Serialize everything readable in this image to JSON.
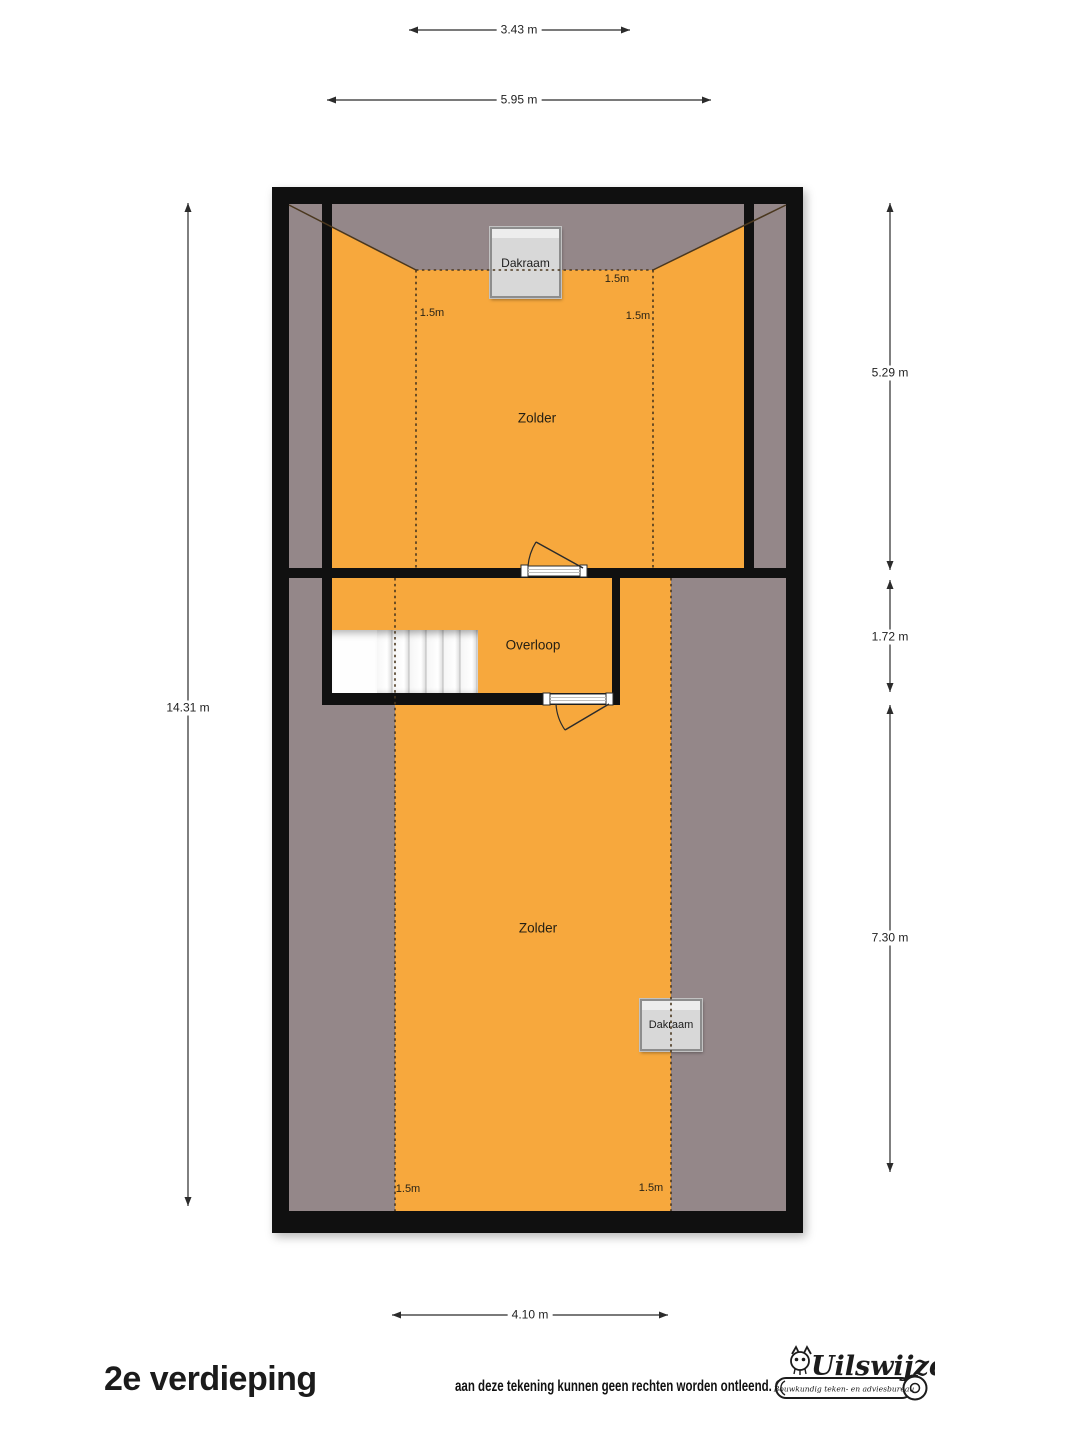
{
  "title": "2e verdieping",
  "disclaimer": "aan deze tekening kunnen geen rechten worden ontleend. ©",
  "logo": {
    "name": "Uilswijze",
    "tagline": "Bouwkundig teken- en adviesbureau"
  },
  "colors": {
    "room": "#F7A83D",
    "lowroom": "#948789",
    "wall": "#101010",
    "skylight": "#D8D8D8",
    "skylightBorder": "#8D8D8D",
    "planline": "#4A371E",
    "dim": "#2B2B2B",
    "ink": "#1A1A1A"
  },
  "rooms": {
    "zolder_top": "Zolder",
    "overloop": "Overloop",
    "zolder_bottom": "Zolder"
  },
  "skylights": {
    "top": "Dakraam",
    "bottom": "Dakraam"
  },
  "headroom_marks": {
    "upper_ridge": "1.5m",
    "upper_left": "1.5m",
    "upper_right": "1.5m",
    "lower_left": "1.5m",
    "lower_right": "1.5m"
  },
  "dimensions": {
    "top_inner": "3.43 m",
    "top_outer": "5.95 m",
    "left": "14.31 m",
    "right_upper": "5.29 m",
    "right_middle": "1.72 m",
    "right_lower": "7.30 m",
    "bottom": "4.10 m"
  }
}
